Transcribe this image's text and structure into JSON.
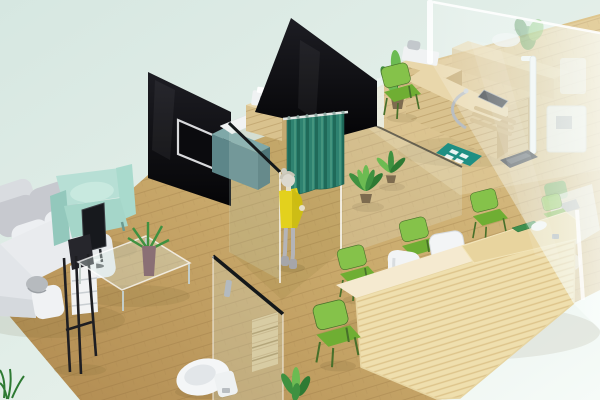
{
  "scene": {
    "title": "Isometric 3D interior render of a small clinic",
    "description": "3D isometric render: waiting lounge with white sectional sofa and mint armchair, black glass partition walls with wall TV, teal privacy curtain, woman in yellow dress, wooden exam desk with medical devices, height rod and weighing scale, light pine reception desk with green chairs, toilet behind a glass door, potted plants, wooden plank floor, large glass wall on the right, pale mint background.",
    "background": {
      "top_left": "#d6e7e1",
      "middle": "#e4efe9",
      "bottom_right": "#f6fbf8"
    },
    "palette": {
      "floor_dark": "#b08a50",
      "floor_main": "#c9a96b",
      "floor_light": "#dec68f",
      "plank": "#8b6a3a",
      "panel_top": "#1d1d23",
      "panel_bottom": "#050507",
      "tv_frame": "#d9dadc",
      "tv_screen": "#0b0b0e",
      "teal_cabinet": "#5d8689",
      "teal_cabinet_top": "#7fa8a8",
      "teal_cabinet_side": "#4e7578",
      "wood": "#d9c28e",
      "wood_light": "#e9d7ab",
      "wood_side": "#c5aa72",
      "wood_grain": "#b2925c",
      "device_white": "#f0f2f3",
      "device_gray": "#c0c6ca",
      "screen_dark": "#2b3036",
      "curtain": "#2e8270",
      "curtain_dark": "#1f6a59",
      "curtain_light": "#4a9a82",
      "glass": "#dcefe7",
      "glass_edge": "#ffffff",
      "rail": "#14181a",
      "sofa": "#e9ebee",
      "sofa_shadow": "#d2d6da",
      "cushion": "#c7c9cf",
      "pillow": "#edeff2",
      "dome": "#b6babe",
      "armchair": "#b7dfd5",
      "armchair_dark": "#93c8bc",
      "armchair_seat": "#a5d6c9",
      "chair_green": "#6fae33",
      "chair_green_top": "#85c24a",
      "chair_leg": "#47702a",
      "desk_pine": "#efdfae",
      "desk_stripe": "#d9bd82",
      "desk_top": "#f5ead0",
      "desk_raised": "#e8d49e",
      "pad_green": "#3f8f4e",
      "office_white": "#f3f5f6",
      "office_shadow": "#d7dbde",
      "dress": "#e3d11d",
      "dress_dark": "#b7a90e",
      "skin": "#e6dfc9",
      "hair": "#d4d1c4",
      "leg": "#b4b4b8",
      "boot": "#a6a6aa",
      "plant": "#3f9140",
      "plant_light": "#6cbb52",
      "plant_dark": "#2e7a33",
      "pot": "#7d6b4f",
      "mat": "#1f8f83",
      "mat_tile": "#ffffff",
      "toilet": "#f4f6f7",
      "toilet_inner": "#e2e6e9",
      "metal": "#b9bec2",
      "scale": "#3a3f45",
      "vase": "#8a6f75",
      "shadow": "#5a4a22"
    },
    "rooms": [
      "waiting-lounge",
      "consultation-room",
      "exam-room",
      "measurement-area",
      "reception",
      "toilet"
    ],
    "objects": [
      {
        "name": "wood-plank-floor",
        "color_key": "floor_main"
      },
      {
        "name": "sectional-sofa",
        "color_key": "sofa"
      },
      {
        "name": "lounge-armchair",
        "color_key": "armchair"
      },
      {
        "name": "lounge-tv",
        "color_key": "tv_screen"
      },
      {
        "name": "glass-coffee-table",
        "color_key": "glass"
      },
      {
        "name": "table-plant-vase",
        "color_key": "vase"
      },
      {
        "name": "drawer-unit",
        "color_key": "device_white"
      },
      {
        "name": "display-easel",
        "color_key": "panel_top"
      },
      {
        "name": "black-glass-panel-left",
        "color_key": "panel_top"
      },
      {
        "name": "black-glass-panel-center",
        "color_key": "panel_top"
      },
      {
        "name": "wall-mounted-tv",
        "color_key": "tv_frame"
      },
      {
        "name": "teal-storage-cabinet",
        "color_key": "teal_cabinet"
      },
      {
        "name": "device-cabinet-printer",
        "color_key": "wood"
      },
      {
        "name": "device-cabinet-monitor",
        "color_key": "wood"
      },
      {
        "name": "privacy-curtain",
        "color_key": "curtain"
      },
      {
        "name": "standing-person-yellow-dress",
        "color_key": "dress"
      },
      {
        "name": "glass-partition-walls",
        "color_key": "glass"
      },
      {
        "name": "potted-plants",
        "color_key": "plant"
      },
      {
        "name": "exam-desk",
        "color_key": "wood_light"
      },
      {
        "name": "exam-monitor",
        "color_key": "screen_dark"
      },
      {
        "name": "chrome-arm",
        "color_key": "metal"
      },
      {
        "name": "height-measuring-rod",
        "color_key": "device_white"
      },
      {
        "name": "weighing-scale",
        "color_key": "scale"
      },
      {
        "name": "teal-floor-mat",
        "color_key": "mat"
      },
      {
        "name": "toilet",
        "color_key": "toilet"
      },
      {
        "name": "toilet-shelf",
        "color_key": "wood"
      },
      {
        "name": "glass-door-handle",
        "color_key": "metal"
      },
      {
        "name": "reception-desk",
        "color_key": "desk_pine"
      },
      {
        "name": "reception-counter-pad",
        "color_key": "pad_green"
      },
      {
        "name": "reception-phone",
        "color_key": "office_white"
      },
      {
        "name": "office-chair",
        "color_key": "office_white"
      },
      {
        "name": "visitor-chair",
        "color_key": "office_white"
      },
      {
        "name": "green-chairs-x6",
        "color_key": "chair_green"
      },
      {
        "name": "glass-wall-right",
        "color_key": "glass_edge"
      },
      {
        "name": "back-counter-sink",
        "color_key": "wood"
      },
      {
        "name": "wall-equipment",
        "color_key": "device_white"
      }
    ]
  }
}
